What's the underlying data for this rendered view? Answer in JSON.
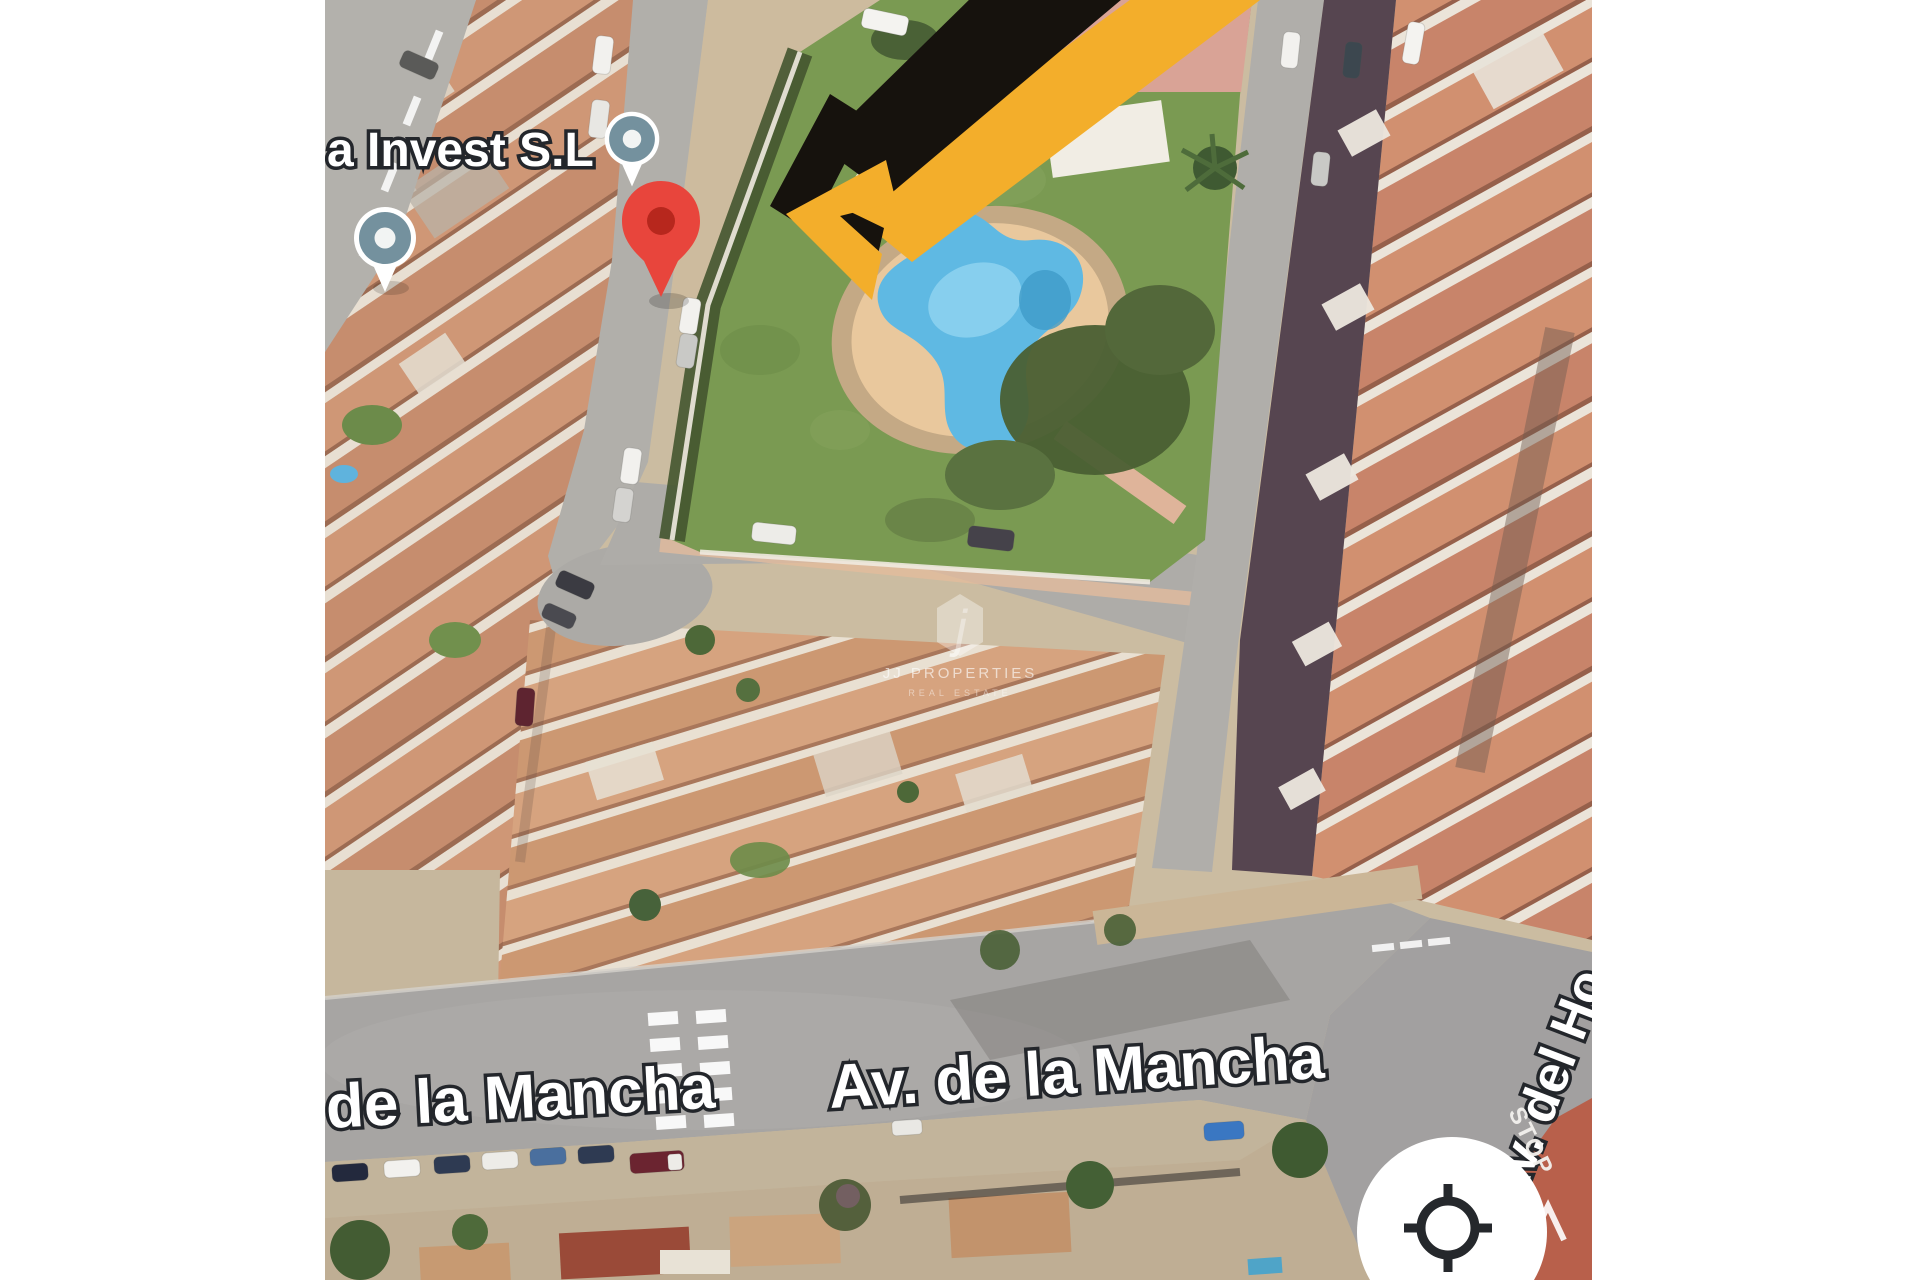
{
  "window": {
    "width": 1920,
    "height": 1280,
    "letterbox_color": "#ffffff"
  },
  "map": {
    "view": "satellite-aerial",
    "place_labels": {
      "business": "a Invest S.L",
      "road_left_partial": "de la Mancha",
      "road_main": "Av. de la Mancha",
      "road_right_vertical": "Av. del Ho",
      "stop_marking": "STOP"
    },
    "markers": {
      "destination_pin": "red-map-pin",
      "business_pins": "grey-dot-pin",
      "business_pin_count": 2
    },
    "annotation": {
      "arrow_primary": "black-hand-drawn-arrow",
      "arrow_secondary": "yellow-hand-drawn-arrow",
      "arrow_black_color": "#16120d",
      "arrow_yellow_color": "#f3ae2b"
    },
    "watermark": {
      "logo_letter": "j",
      "title": "JJ PROPERTIES",
      "subtitle": "REAL ESTATE"
    },
    "controls": {
      "locate_button_icon": "my-location-crosshair"
    },
    "colors": {
      "pin_red": "#e8453c",
      "pin_red_inner": "#b7271d",
      "pin_grey": "#74919e",
      "pool_blue": "#5fb9e3",
      "grass_green": "#7a9a52",
      "roof_terracotta": "#c8886a",
      "road_grey": "#a7a5a3",
      "deck_tan": "#e9c89d"
    }
  }
}
